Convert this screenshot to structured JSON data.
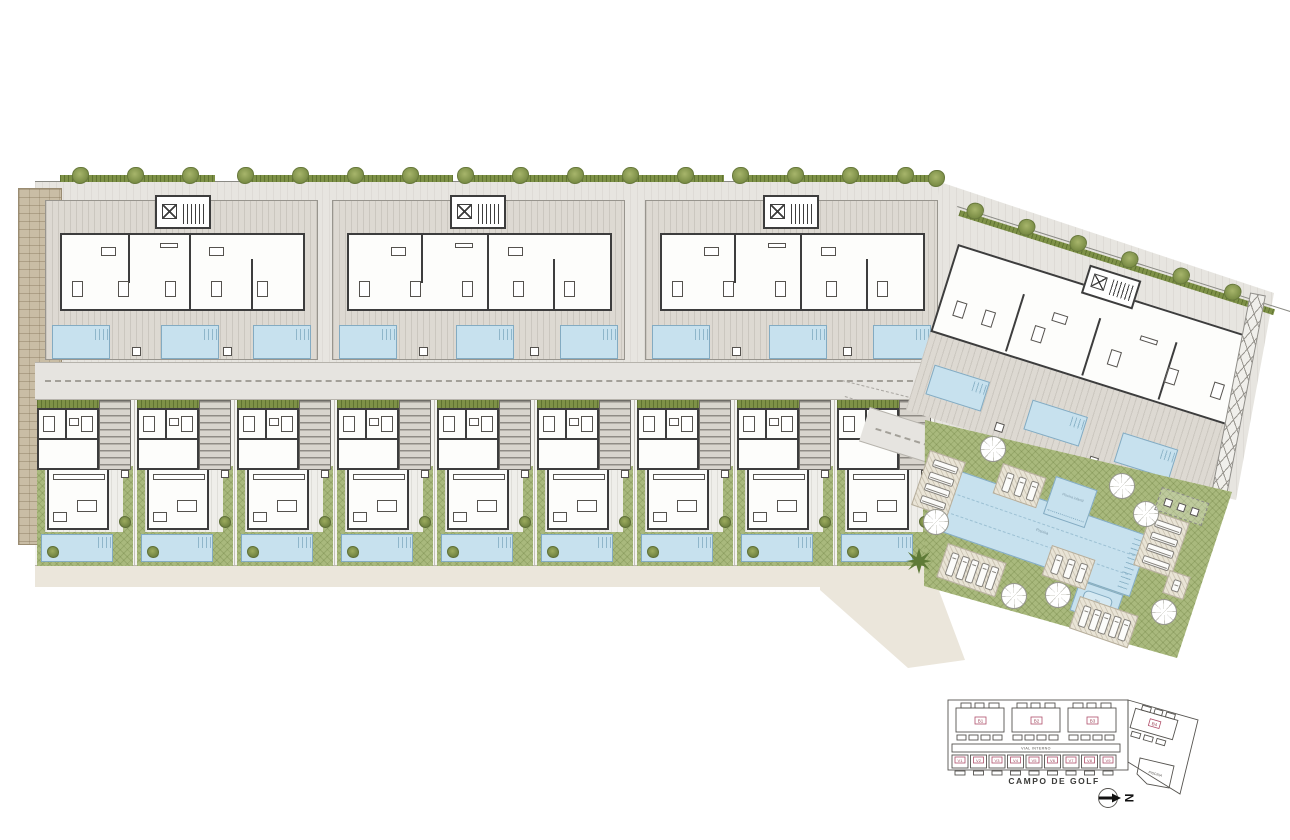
{
  "plan": {
    "title": "Residential development site plan",
    "golf_label": "CAMPO DE GOLF",
    "north_letter": "N",
    "keymap": {
      "road_label": "VIAL INTERNO",
      "pool_area_label": "PISCINA",
      "block_labels": [
        "B1",
        "B2",
        "B3",
        "B4"
      ],
      "villa_labels": [
        "V1",
        "V2",
        "V3",
        "V4",
        "V5",
        "V6",
        "V7",
        "V8",
        "V9"
      ]
    },
    "communal": {
      "main_pool_label": "Piscina",
      "kids_pool_label": "Piscina infantil",
      "jacuzzi_label": "Spa"
    },
    "counts": {
      "apartment_blocks": 4,
      "villas": 9,
      "pools_per_block": 3,
      "villa_pools": 9,
      "communal_pools": 3,
      "parasols": 7,
      "lounger_decks": 7,
      "perimeter_trees": 23
    },
    "colors": {
      "lawn": "#a9b97d",
      "pool_water": "#c7e1ee",
      "walls": "#3d3d3d",
      "deck": "#ddd9d2",
      "road": "#e6e4e0",
      "hedge": "#7e9147",
      "paver": "#c9bda5",
      "keymap_label_red": "#9c4558"
    }
  }
}
